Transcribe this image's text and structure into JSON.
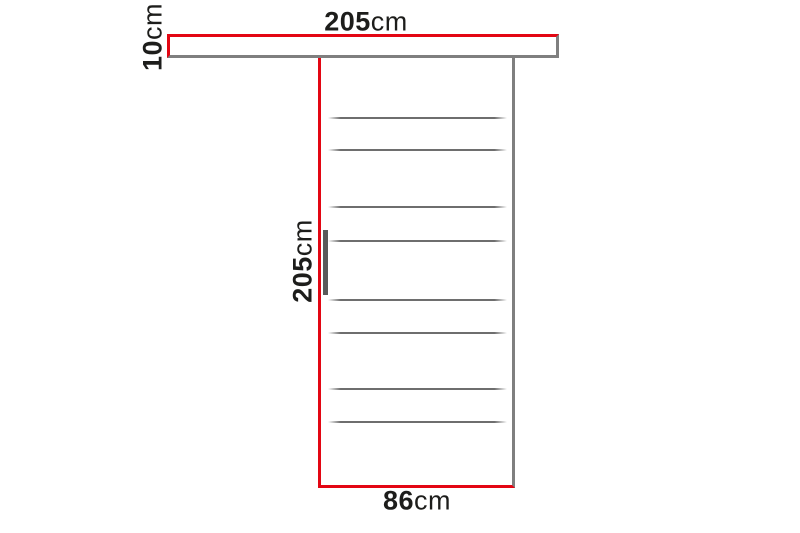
{
  "diagram": {
    "kind": "sliding-door-dimension-diagram",
    "subject": "sliding door panel hung on a top rail, with dimension lines"
  },
  "colors": {
    "dimension_red": "#e30613",
    "outline_gray": "#7f7f7f",
    "slat_gray": "#6e6e6e",
    "handle_gray": "#5a5a5a",
    "text": "#1d1d1b",
    "background": "#ffffff"
  },
  "dimensions": {
    "rail_width": {
      "value": "205",
      "unit": "cm"
    },
    "rail_height": {
      "value": "10",
      "unit": "cm"
    },
    "door_height": {
      "value": "205",
      "unit": "cm"
    },
    "door_width": {
      "value": "86",
      "unit": "cm"
    }
  },
  "door": {
    "slat_count": 8,
    "slat_offsets_px": [
      59,
      91,
      148,
      182,
      241,
      274,
      330,
      363
    ]
  }
}
